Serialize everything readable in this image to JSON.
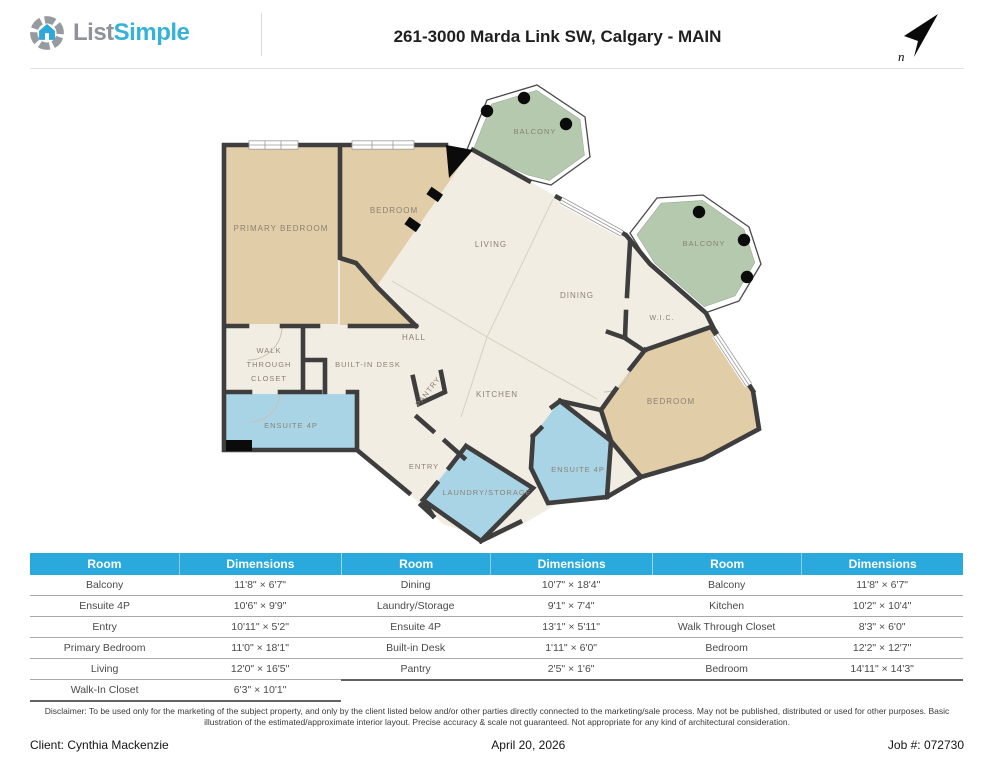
{
  "header": {
    "logo_word1": "List",
    "logo_word2": "Simple",
    "title": "261-3000 Marda Link SW, Calgary - MAIN",
    "compass_letter": "n"
  },
  "floorplan": {
    "colors": {
      "floor": "#f2ede3",
      "bedroom": "#e2cda9",
      "balcony": "#b4c9ae",
      "bathroom": "#a9d4e5",
      "wall": "#3e3e3e",
      "label": "#8a8174"
    },
    "labels": [
      {
        "id": "balcony-top",
        "text": "BALCONY",
        "x": 535,
        "y": 134,
        "s": 7.5
      },
      {
        "id": "balcony-right",
        "text": "BALCONY",
        "x": 704,
        "y": 246,
        "s": 7.5
      },
      {
        "id": "primary-bedroom",
        "text": "PRIMARY BEDROOM",
        "x": 281,
        "y": 231,
        "s": 8
      },
      {
        "id": "bedroom-top",
        "text": "BEDROOM",
        "x": 394,
        "y": 213,
        "s": 8
      },
      {
        "id": "living",
        "text": "LIVING",
        "x": 491,
        "y": 247,
        "s": 8
      },
      {
        "id": "dining",
        "text": "DINING",
        "x": 577,
        "y": 298,
        "s": 8
      },
      {
        "id": "wic",
        "text": "W.I.C.",
        "x": 662,
        "y": 320,
        "s": 7
      },
      {
        "id": "hall",
        "text": "HALL",
        "x": 414,
        "y": 340,
        "s": 8
      },
      {
        "id": "walk",
        "text": "WALK",
        "x": 269,
        "y": 353,
        "s": 7.5
      },
      {
        "id": "through",
        "text": "THROUGH",
        "x": 269,
        "y": 367,
        "s": 7.5
      },
      {
        "id": "closet",
        "text": "CLOSET",
        "x": 269,
        "y": 381,
        "s": 7.5
      },
      {
        "id": "built-in-desk",
        "text": "BUILT-IN DESK",
        "x": 368,
        "y": 367,
        "s": 7.5
      },
      {
        "id": "ensuite-left",
        "text": "ENSUITE 4P",
        "x": 291,
        "y": 428,
        "s": 7.5
      },
      {
        "id": "pantry",
        "text": "PANTRY",
        "x": 430,
        "y": 393,
        "s": 7.5,
        "r": -52
      },
      {
        "id": "kitchen",
        "text": "KITCHEN",
        "x": 497,
        "y": 397,
        "s": 8
      },
      {
        "id": "bedroom-right",
        "text": "BEDROOM",
        "x": 671,
        "y": 404,
        "s": 8
      },
      {
        "id": "entry",
        "text": "ENTRY",
        "x": 424,
        "y": 469,
        "s": 7.5
      },
      {
        "id": "ensuite-right",
        "text": "ENSUITE 4P",
        "x": 578,
        "y": 472,
        "s": 7.5
      },
      {
        "id": "laundry",
        "text": "LAUNDRY/STORAGE",
        "x": 487,
        "y": 495,
        "s": 7.5
      }
    ]
  },
  "tables": [
    {
      "headers": [
        "Room",
        "Dimensions"
      ],
      "rows": [
        [
          "Balcony",
          "11'8\" × 6'7\""
        ],
        [
          "Ensuite 4P",
          "10'6\" × 9'9\""
        ],
        [
          "Entry",
          "10'11\" × 5'2\""
        ],
        [
          "Primary Bedroom",
          "11'0\" × 18'1\""
        ],
        [
          "Living",
          "12'0\" × 16'5\""
        ],
        [
          "Walk-In Closet",
          "6'3\" × 10'1\""
        ]
      ]
    },
    {
      "headers": [
        "Room",
        "Dimensions"
      ],
      "rows": [
        [
          "Dining",
          "10'7\" × 18'4\""
        ],
        [
          "Laundry/Storage",
          "9'1\" × 7'4\""
        ],
        [
          "Ensuite 4P",
          "13'1\" × 5'11\""
        ],
        [
          "Built-in Desk",
          "1'11\" × 6'0\""
        ],
        [
          "Pantry",
          "2'5\" × 1'6\""
        ]
      ]
    },
    {
      "headers": [
        "Room",
        "Dimensions"
      ],
      "rows": [
        [
          "Balcony",
          "11'8\" × 6'7\""
        ],
        [
          "Kitchen",
          "10'2\" × 10'4\""
        ],
        [
          "Walk Through Closet",
          "8'3\" × 6'0\""
        ],
        [
          "Bedroom",
          "12'2\" × 12'7\""
        ],
        [
          "Bedroom",
          "14'11\" × 14'3\""
        ]
      ]
    }
  ],
  "disclaimer": "Disclaimer: To be used only for the marketing of the subject property, and only by the client listed below and/or other parties directly connected to the marketing/sale process. May not be published, distributed or used for other purposes. Basic illustration of the estimated/approximate interior layout. Precise accuracy & scale not guaranteed. Not appropriate for any kind of architectural consideration.",
  "footer": {
    "client": "Client: Cynthia Mackenzie",
    "date": "April 20, 2026",
    "job": "Job #: 072730"
  }
}
